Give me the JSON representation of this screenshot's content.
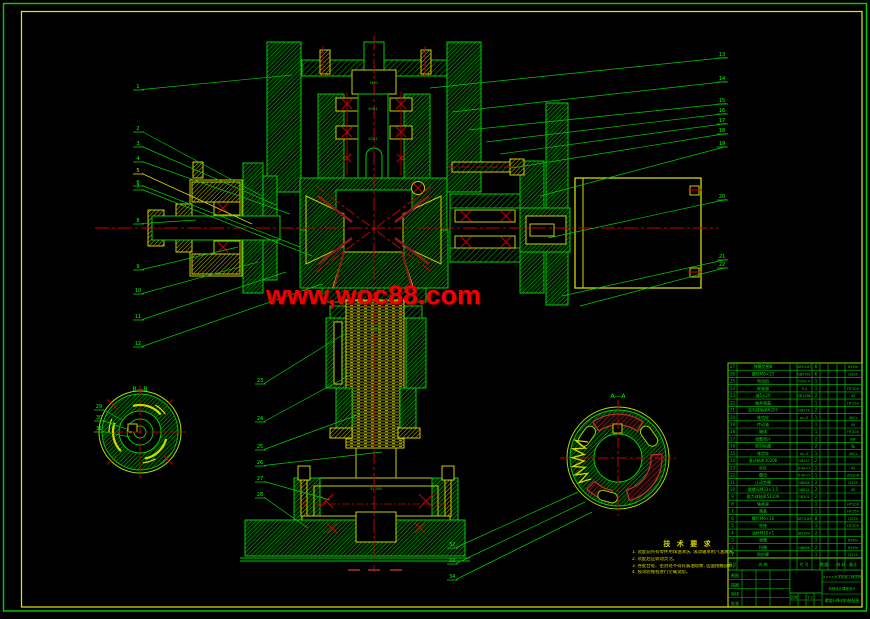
{
  "watermark": {
    "text": "www,woc88.com",
    "color": "#f00000"
  },
  "frame": {
    "outer_color": "#00d000",
    "inner_color": "#e8e800"
  },
  "section_labels": {
    "left_view": "B—B",
    "right_view": "A—A"
  },
  "balloons": {
    "left": [
      "1",
      "2",
      "3",
      "4",
      "5",
      "6",
      "7",
      "8",
      "9",
      "10",
      "11",
      "12"
    ],
    "right": [
      "13",
      "14",
      "15",
      "16",
      "17",
      "18",
      "19",
      "20",
      "21",
      "22"
    ],
    "screw": [
      "23",
      "24",
      "25",
      "26",
      "27",
      "28"
    ],
    "left_view": [
      "29",
      "30",
      "31"
    ],
    "right_view": [
      "32",
      "33",
      "34"
    ]
  },
  "inline_marks": [
    "6204",
    "6204",
    "M30",
    "Tr40×7",
    "51106"
  ],
  "notes": {
    "title": "技 术 要 求",
    "lines": [
      "1. 装配前所有零件用煤油清洗, 滚动轴承用汽油清洗。",
      "2. 装配后应转动灵活。",
      "3. 各配合处、密封处不得有漏油现象, 齿面接触良好。",
      "4. 按试验规程进行空载试验。"
    ]
  },
  "bom": {
    "rows": [
      [
        "27",
        "弹簧垫圈8",
        "GB93-87",
        "6",
        "65Mn"
      ],
      [
        "26",
        "螺栓M8×25",
        "GB5782",
        "6",
        "Q235"
      ],
      [
        "25",
        "电动机",
        "Y90S-4",
        "1",
        ""
      ],
      [
        "24",
        "联轴器",
        "TL4",
        "1",
        "HT200"
      ],
      [
        "23",
        "键5×20",
        "GB1096",
        "2",
        "45"
      ],
      [
        "22",
        "轴承端盖",
        "",
        "1",
        "HT150"
      ],
      [
        "21",
        "深沟球轴承6205",
        "GB276",
        "2",
        ""
      ],
      [
        "20",
        "锥齿轮",
        "m=3",
        "1",
        "40Cr"
      ],
      [
        "19",
        "传动轴",
        "",
        "1",
        "45"
      ],
      [
        "18",
        "箱体",
        "",
        "1",
        "HT200"
      ],
      [
        "17",
        "调整垫片",
        "",
        "2",
        "08F"
      ],
      [
        "16",
        "密封毡圈",
        "",
        "2",
        "毡"
      ],
      [
        "15",
        "锥齿轮",
        "m=3",
        "1",
        "40Cr"
      ],
      [
        "14",
        "滚动轴承30206",
        "GB297",
        "2",
        ""
      ],
      [
        "13",
        "丝杠",
        "Tr40×7",
        "1",
        "45"
      ],
      [
        "12",
        "螺母",
        "Tr40×7",
        "1",
        "ZQSn6"
      ],
      [
        "11",
        "止动垫圈",
        "GB858",
        "2",
        "Q235"
      ],
      [
        "10",
        "圆螺母M33×1.5",
        "GB812",
        "2",
        "45"
      ],
      [
        "9",
        "推力球轴承51106",
        "GB301",
        "2",
        ""
      ],
      [
        "8",
        "轴承座",
        "",
        "1",
        "HT200"
      ],
      [
        "7",
        "端盖",
        "",
        "1",
        "HT150"
      ],
      [
        "6",
        "螺钉M6×16",
        "GB70-85",
        "8",
        "Q235"
      ],
      [
        "5",
        "底座",
        "",
        "1",
        "HT200"
      ],
      [
        "4",
        "油杯M10×1",
        "JB7940",
        "2",
        ""
      ],
      [
        "3",
        "弹簧",
        "",
        "1",
        "65Mn"
      ],
      [
        "2",
        "挡圈",
        "GB894",
        "2",
        "65Mn"
      ],
      [
        "1",
        "防护罩",
        "",
        "1",
        "Q215"
      ]
    ]
  },
  "title_block": {
    "header_cells": [
      "序号",
      "名  称",
      "代 号",
      "数量",
      "材 料",
      "备注"
    ],
    "sig_labels": [
      "制图",
      "描图",
      "审核",
      "批准"
    ],
    "scale_label": "比例",
    "scale_value": "1:2",
    "right_lines": [
      "××××大学机械工程学院",
      "机械设计课程设计"
    ],
    "drawing_name": "螺旋升降机构装配图"
  }
}
